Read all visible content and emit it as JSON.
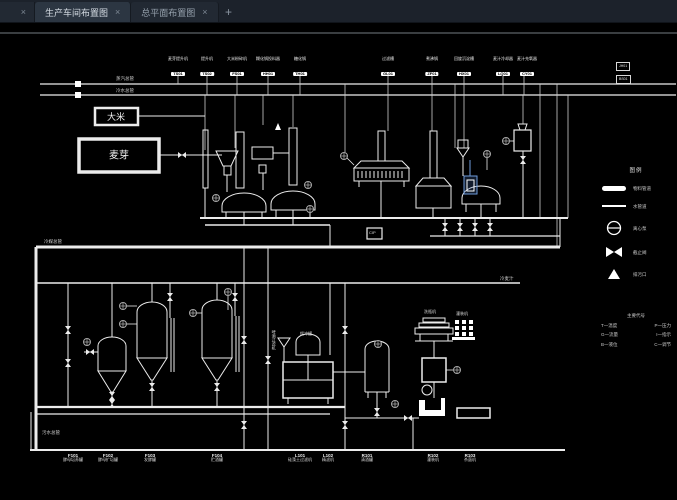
{
  "tabbar": {
    "partial_tab_close": "×",
    "tabs": [
      {
        "label": "生产车间布置图",
        "close": "×"
      },
      {
        "label": "总平面布置图",
        "close": "×"
      }
    ],
    "new_tab_label": "+"
  },
  "canvas": {
    "supply_labels": {
      "steam": "蒸汽总管",
      "cold_water": "冷水总管",
      "coolant": "冷媒总管",
      "sewage": "污水总管",
      "cold_wort": "冷麦汁"
    },
    "sources": {
      "rice": "大米",
      "malt": "麦芽"
    },
    "top_equipment": [
      {
        "name": "麦芽提升机",
        "code": "TS01"
      },
      {
        "name": "提升机",
        "code": "TS02"
      },
      {
        "name": "大米粉碎机",
        "code": "FS01"
      },
      {
        "name": "糊化锅投料器",
        "code": "HH01"
      },
      {
        "name": "糖化锅",
        "code": "TH01"
      },
      {
        "name": "过滤槽",
        "code": "GL01"
      },
      {
        "name": "煮沸锅",
        "code": "ZF01"
      },
      {
        "name": "回旋沉淀槽",
        "code": "HX01"
      },
      {
        "name": "麦汁冷却器",
        "code": "LQ01"
      },
      {
        "name": "麦汁充氧器",
        "code": "CY01"
      }
    ],
    "station_boxes": [
      {
        "code": "JH01"
      },
      {
        "code": "BS01"
      }
    ],
    "cip_label": "CIP",
    "filter_vertical_label": "啤酒过滤机",
    "buffer_label": "缓冲罐",
    "washer_label": "洗瓶机",
    "filler_label": "灌装机",
    "bottom_equipment": [
      {
        "code": "F101",
        "name": "酵母培养罐"
      },
      {
        "code": "F102",
        "name": "酵母扩培罐"
      },
      {
        "code": "F103",
        "name": "发酵罐"
      },
      {
        "code": "F104",
        "name": "贮酒罐"
      },
      {
        "code": "L101",
        "name": "硅藻土过滤机"
      },
      {
        "code": "L102",
        "name": "精滤机"
      },
      {
        "code": "R101",
        "name": "清酒罐"
      },
      {
        "code": "R102",
        "name": "灌装机"
      },
      {
        "code": "R103",
        "name": "杀菌机"
      }
    ],
    "legend": {
      "title": "图例",
      "items": [
        "物料管道",
        "水管道",
        "离心泵",
        "截止阀",
        "排污口"
      ]
    },
    "codes_note": {
      "title": "主要代号",
      "entries": [
        [
          "T一温度",
          "P一压力"
        ],
        [
          "G一流量",
          "I一指示"
        ],
        [
          "B一液位",
          "C一调节"
        ]
      ]
    },
    "colors": {
      "line": "#ececec",
      "selection": "#6f9ddc",
      "background": "#000000"
    }
  }
}
